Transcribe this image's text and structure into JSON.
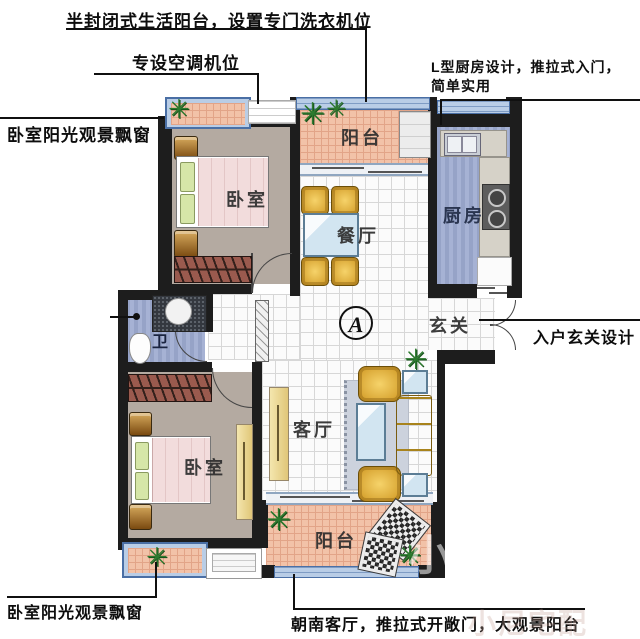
{
  "annotations": {
    "balcony_top": "半封闭式生活阳台，设置专门洗衣机位",
    "ac_unit": "专设空调机位",
    "kitchen_line1": "L型厨房设计，推拉式入门，",
    "kitchen_line2": "简单实用",
    "bay_window_top": "卧室阳光观景飘窗",
    "entry": "入户玄关设计",
    "bay_window_bottom": "卧室阳光观景飘窗",
    "living_south": "朝南客厅，推拉式开敞门，大观景阳台"
  },
  "rooms": {
    "balcony_top": "阳台",
    "bedroom_top": "卧室",
    "dining": "餐厅",
    "kitchen": "厨房",
    "bathroom": "卫",
    "entry_hall": "玄关",
    "living": "客厅",
    "bedroom_bottom": "卧室",
    "balcony_bottom": "阳台",
    "unit_marker": "A"
  },
  "watermarks": {
    "main": "小尼宅配",
    "corner": "小尼宅配"
  },
  "palette": {
    "wall": "#1d1d1d",
    "balcony_tile": "#f2c2a8",
    "window_frame": "#b9cde6",
    "window_border": "#4a6fa5",
    "wet_floor": "#9aa7c9",
    "bedroom_floor": "#b4aaa1",
    "furniture_yellow": "#eec04a",
    "wardrobe": "#9a5a4e",
    "glass": "#cfe4f0"
  }
}
